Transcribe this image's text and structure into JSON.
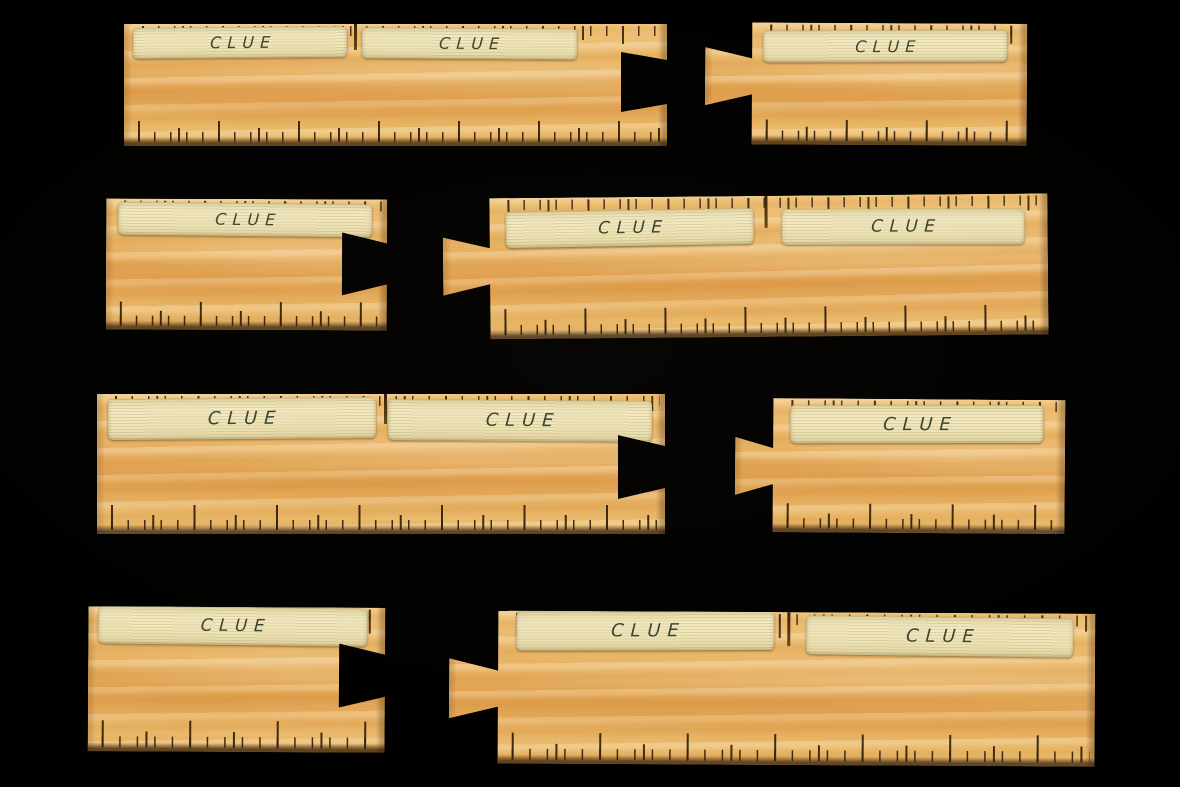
{
  "scene": {
    "background_color": "#000000"
  },
  "colors": {
    "background": "#000000",
    "wood": "#e6b162",
    "wood_highlight": "#f0ca86",
    "wood_shadow": "#c98f3e",
    "tape": "#ece2b6",
    "ink": "#3d452f",
    "tick": "#3a2810"
  },
  "pieces": [
    {
      "name": "ruler-piece-1-left",
      "connector": "slot-right",
      "labels": [
        "CLUE",
        "CLUE"
      ]
    },
    {
      "name": "ruler-piece-1-right",
      "connector": "tab-left",
      "labels": [
        "CLUE"
      ]
    },
    {
      "name": "ruler-piece-2-left",
      "connector": "slot-right",
      "labels": [
        "CLUE"
      ]
    },
    {
      "name": "ruler-piece-2-right",
      "connector": "tab-left",
      "labels": [
        "CLUE",
        "CLUE"
      ]
    },
    {
      "name": "ruler-piece-3-left",
      "connector": "slot-right",
      "labels": [
        "CLUE",
        "CLUE"
      ]
    },
    {
      "name": "ruler-piece-3-right",
      "connector": "tab-left",
      "labels": [
        "CLUE"
      ]
    },
    {
      "name": "ruler-piece-4-left",
      "connector": "slot-right",
      "labels": [
        "CLUE"
      ]
    },
    {
      "name": "ruler-piece-4-right",
      "connector": "tab-left",
      "labels": [
        "CLUE",
        "CLUE"
      ]
    }
  ]
}
